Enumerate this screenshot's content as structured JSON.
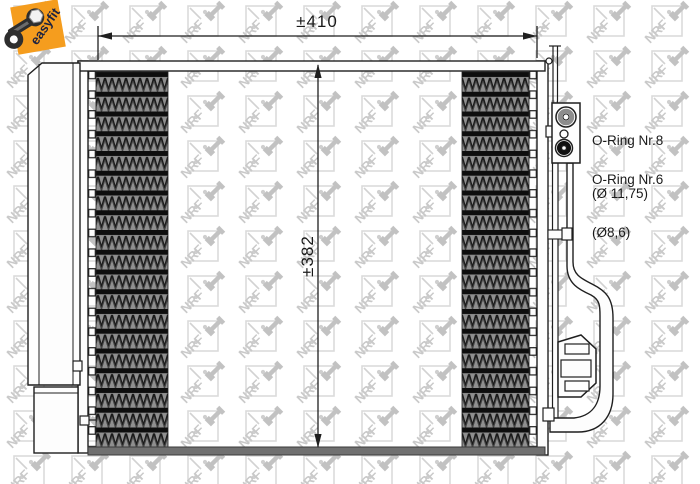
{
  "badge": {
    "label": "easyfit",
    "color": "#f59d1e",
    "text_color": "#1c2240",
    "icon": "wrench-icon"
  },
  "dimensions": {
    "width_label": "±410",
    "height_label": "±382"
  },
  "annotations": {
    "oring8": {
      "line1": "O-Ring Nr.8",
      "line2": "(Ø 11,75)"
    },
    "oring6": {
      "line1": "O-Ring Nr.6",
      "line2": "(Ø8,6)"
    }
  },
  "watermark": {
    "text": "NRF",
    "icon": "nrf-wrench-logo",
    "color": "#c9c9c9"
  }
}
